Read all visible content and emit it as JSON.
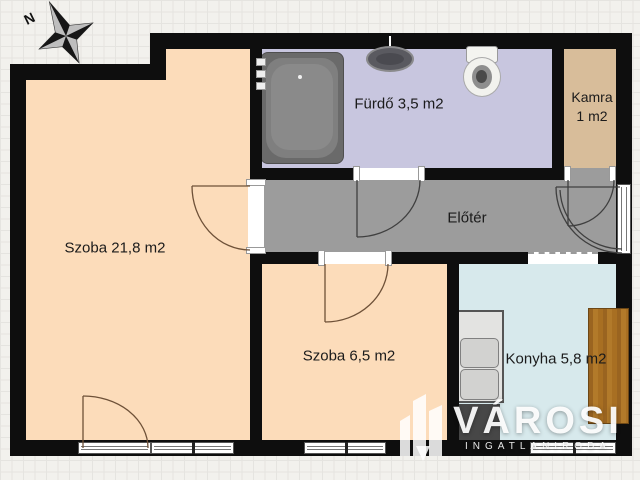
{
  "compass": {
    "north_label": "N"
  },
  "rooms": {
    "szoba_large": {
      "label": "Szoba 21,8 m2"
    },
    "furdo": {
      "label": "Fürdő 3,5 m2"
    },
    "kamra": {
      "label_line1": "Kamra",
      "label_line2": "1 m2"
    },
    "eloter": {
      "label": "Előtér"
    },
    "szoba_small": {
      "label": "Szoba 6,5 m2"
    },
    "konyha": {
      "label": "Konyha 5,8 m2"
    }
  },
  "logo": {
    "brand": "VÁROSI",
    "subtitle": "INGATLANIRODA"
  },
  "colors": {
    "room_peach": "#fcdcba",
    "bathroom_lavender": "#c8c6df",
    "pantry_tan": "#d8bd9a",
    "hallway_gray": "#9c9c9c",
    "kitchen_blue": "#d7e9ec",
    "wall_black": "#0e0e0e",
    "wood_counter": "#a86e22"
  }
}
